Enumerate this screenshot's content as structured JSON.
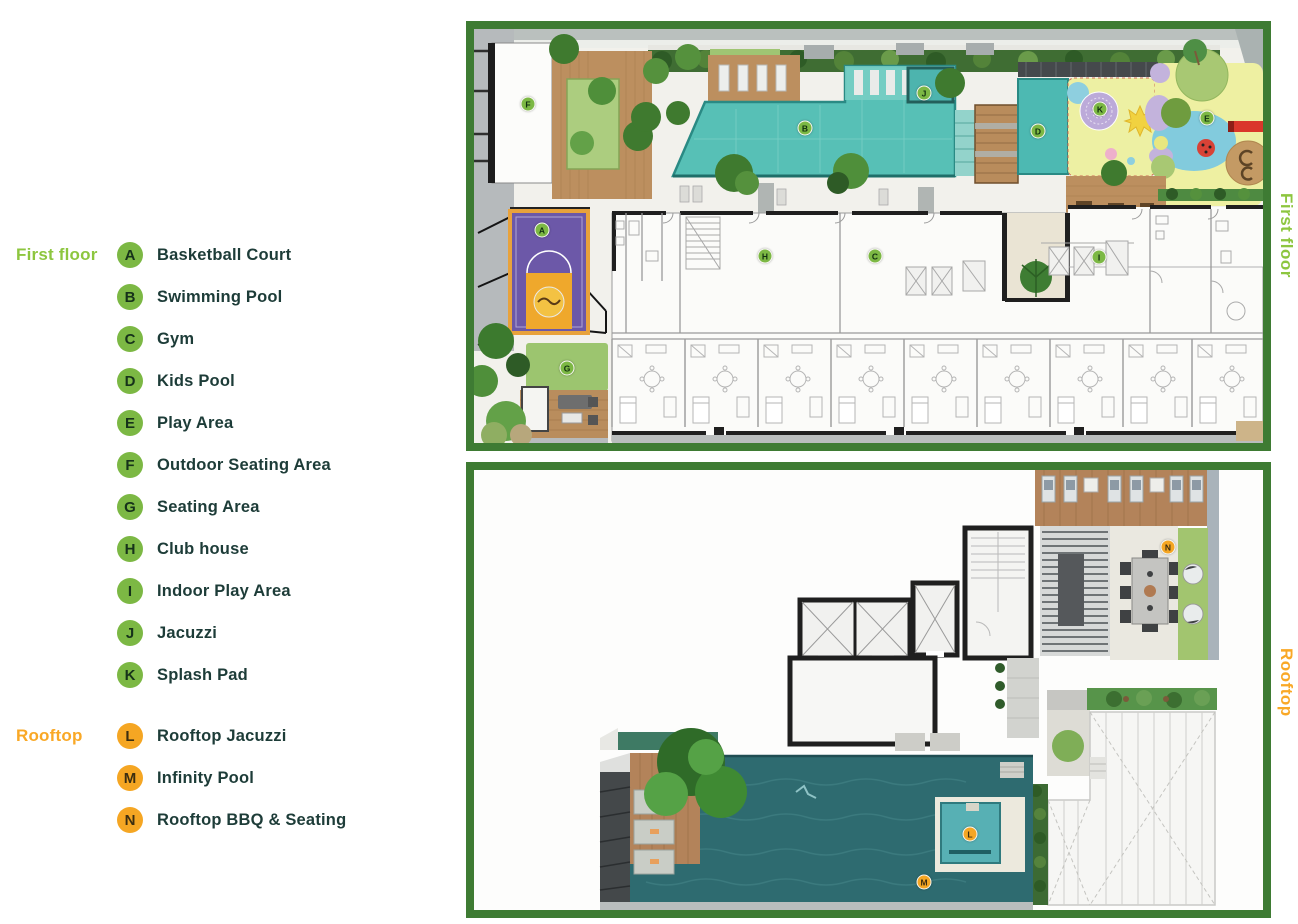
{
  "colors": {
    "legend_green": "#8dc63f",
    "legend_orange": "#f9a826",
    "marker_green": "#7cb844",
    "marker_orange": "#f5a623",
    "label_text": "#1d3c38",
    "panel_border": "#3e7b33"
  },
  "legend": {
    "groups": [
      {
        "title": "First floor",
        "color": "#8dc63f",
        "marker_style": "green",
        "items": [
          {
            "letter": "A",
            "label": "Basketball Court"
          },
          {
            "letter": "B",
            "label": "Swimming Pool"
          },
          {
            "letter": "C",
            "label": "Gym"
          },
          {
            "letter": "D",
            "label": "Kids Pool"
          },
          {
            "letter": "E",
            "label": "Play Area"
          },
          {
            "letter": "F",
            "label": "Outdoor Seating Area"
          },
          {
            "letter": "G",
            "label": "Seating Area"
          },
          {
            "letter": "H",
            "label": "Club house"
          },
          {
            "letter": "I",
            "label": "Indoor Play Area"
          },
          {
            "letter": "J",
            "label": "Jacuzzi"
          },
          {
            "letter": "K",
            "label": "Splash Pad"
          }
        ]
      },
      {
        "title": "Rooftop",
        "color": "#f9a826",
        "marker_style": "orange",
        "items": [
          {
            "letter": "L",
            "label": "Rooftop Jacuzzi"
          },
          {
            "letter": "M",
            "label": "Infinity Pool"
          },
          {
            "letter": "N",
            "label": "Rooftop BBQ & Seating"
          }
        ]
      }
    ]
  },
  "plans": [
    {
      "name": "first-floor",
      "side_label": "First floor",
      "marker_style": "green",
      "markers": [
        {
          "letter": "F",
          "x": 62,
          "y": 83
        },
        {
          "letter": "B",
          "x": 339,
          "y": 107
        },
        {
          "letter": "J",
          "x": 458,
          "y": 72
        },
        {
          "letter": "D",
          "x": 572,
          "y": 110
        },
        {
          "letter": "K",
          "x": 634,
          "y": 88
        },
        {
          "letter": "E",
          "x": 741,
          "y": 97
        },
        {
          "letter": "A",
          "x": 76,
          "y": 209
        },
        {
          "letter": "H",
          "x": 299,
          "y": 235
        },
        {
          "letter": "C",
          "x": 409,
          "y": 235
        },
        {
          "letter": "I",
          "x": 633,
          "y": 236
        },
        {
          "letter": "G",
          "x": 101,
          "y": 347
        }
      ]
    },
    {
      "name": "rooftop",
      "side_label": "Rooftop",
      "marker_style": "orange",
      "markers": [
        {
          "letter": "N",
          "x": 702,
          "y": 85
        },
        {
          "letter": "L",
          "x": 504,
          "y": 372
        },
        {
          "letter": "M",
          "x": 458,
          "y": 420
        }
      ]
    }
  ]
}
